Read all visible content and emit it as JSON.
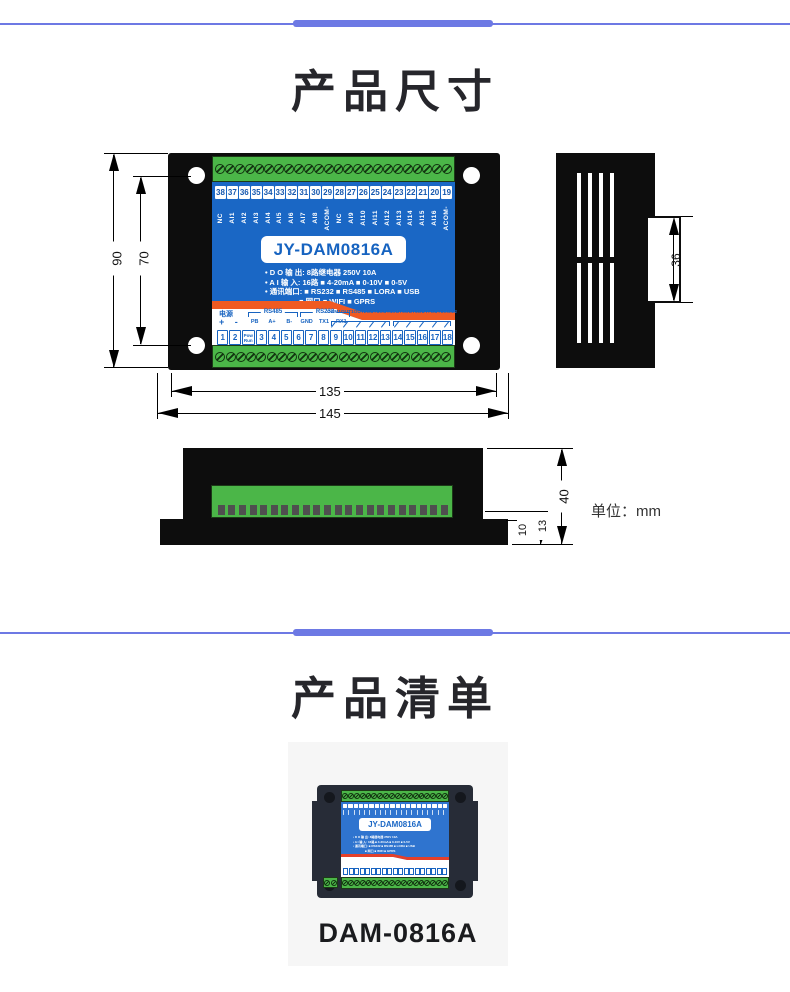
{
  "sections": {
    "dimensions_title": "产品尺寸",
    "list_title": "产品清单"
  },
  "front_view": {
    "model": "JY-DAM0816A",
    "top_terminals": [
      "38",
      "37",
      "36",
      "35",
      "34",
      "33",
      "32",
      "31",
      "30",
      "29",
      "28",
      "27",
      "26",
      "25",
      "24",
      "23",
      "22",
      "21",
      "20",
      "19"
    ],
    "top_labels": [
      "NC",
      "AI1",
      "AI2",
      "AI3",
      "AI4",
      "AI5",
      "AI6",
      "AI7",
      "AI8",
      "ACOM-",
      "NC",
      "AI9",
      "AI10",
      "AI11",
      "AI12",
      "AI13",
      "AI14",
      "AI15",
      "AI16",
      "ACOM-"
    ],
    "specs": [
      "• D O 输 出:  8路继电器 250V 10A",
      "• A I 输 入:  16路 ■ 4-20mA ■ 0-10V ■ 0-5V",
      "• 通讯端口:  ■ RS232 ■ RS485 ■ LORA ■ USB",
      "■ 网口    ■ WIFI    ■ GPRS"
    ],
    "power_label": "电源",
    "power_pins": "+  -",
    "pow_run": [
      "Pow",
      "Run"
    ],
    "rs485_label": "RS485",
    "rs485_pins": [
      "PB",
      "A+",
      "B-"
    ],
    "rs232_label": "RS232",
    "rs232_pins": [
      "GND",
      "TX1",
      "RX1"
    ],
    "out_labels": [
      "COM1",
      "OUT1",
      "OUT2",
      "OUT3",
      "OUT4",
      "OUT5",
      "OUT6",
      "OUT7",
      "OUT8",
      "COM2"
    ],
    "bottom_terminals_left": [
      "1",
      "2"
    ],
    "bottom_terminals_right": [
      "3",
      "4",
      "5",
      "6",
      "7",
      "8",
      "9",
      "10",
      "11",
      "12",
      "13",
      "14",
      "15",
      "16",
      "17",
      "18"
    ]
  },
  "dims": {
    "front_height": "90",
    "front_hole_pitch": "70",
    "front_width_body": "135",
    "front_width_total": "145",
    "side_tab_height": "36",
    "bottom_depth": "40",
    "bottom_step": "13",
    "bottom_flange": "10",
    "unit_label": "单位：mm"
  },
  "product": {
    "name": "DAM-0816A",
    "model": "JY-DAM0816A"
  },
  "colors": {
    "divider_blue": "#6d79e4",
    "panel_blue": "#1a67c5",
    "terminal_green": "#4bb648",
    "stripe_orange": "#f05a22",
    "enclosure_black": "#0d0d0d"
  }
}
